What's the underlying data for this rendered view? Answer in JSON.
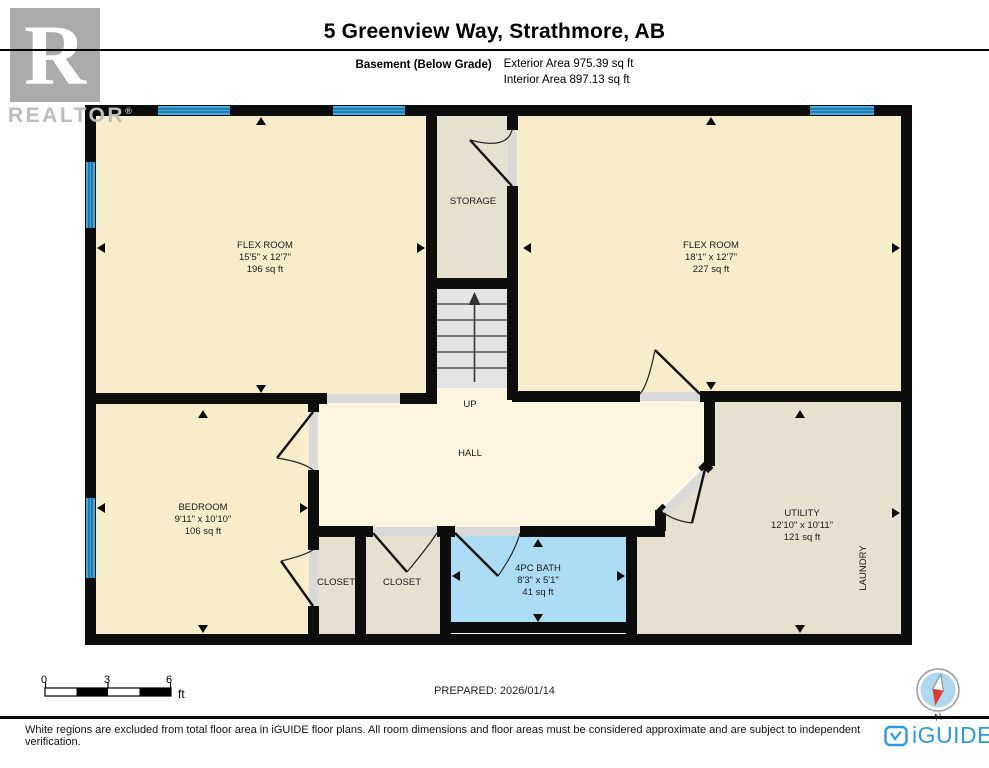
{
  "header": {
    "title": "5 Greenview Way, Strathmore, AB",
    "floor_label": "Basement (Below Grade)",
    "exterior_area": "Exterior Area 975.39 sq ft",
    "interior_area": "Interior Area 897.13 sq ft"
  },
  "realtor": {
    "letter": "R",
    "label": "REALTOR",
    "reg": "®"
  },
  "rooms": {
    "flex_left": {
      "name": "FLEX ROOM",
      "dims": "15'5\" x 12'7\"",
      "area": "196 sq ft"
    },
    "storage": {
      "name": "STORAGE"
    },
    "flex_right": {
      "name": "FLEX ROOM",
      "dims": "18'1\" x 12'7\"",
      "area": "227 sq ft"
    },
    "bedroom": {
      "name": "BEDROOM",
      "dims": "9'11\" x 10'10\"",
      "area": "106 sq ft"
    },
    "hall": {
      "name": "HALL",
      "up_label": "UP"
    },
    "utility": {
      "name": "UTILITY",
      "dims": "12'10\" x 10'11\"",
      "area": "121 sq ft",
      "laundry": "LAUNDRY"
    },
    "closet1": {
      "name": "CLOSET"
    },
    "closet2": {
      "name": "CLOSET"
    },
    "bath": {
      "name": "4PC BATH",
      "dims": "8'3\" x 5'1\"",
      "area": "41 sq ft"
    }
  },
  "footer": {
    "scale": {
      "t0": "0",
      "t3": "3",
      "t6": "6",
      "unit": "ft"
    },
    "prepared": "PREPARED: 2026/01/14",
    "disclaimer": "White regions are excluded from total floor area in iGUIDE floor plans. All room dimensions and floor areas must be considered approximate and are subject to independent verification.",
    "compass_n": "N",
    "brand": "iGUIDE"
  },
  "colors": {
    "room_cream": "#F8EDCB",
    "hall_cream": "#FCF5DF",
    "room_tan": "#E6E0D0",
    "bath_blue": "#ACDCF4",
    "window_blue": "#45A7DA",
    "window_stripe": "#1b6fa0",
    "stair_gray": "#E4E4E4",
    "brand_blue": "#2E9BD6",
    "compass_red": "#E03A2F",
    "compass_face": "#AFD7EF"
  }
}
